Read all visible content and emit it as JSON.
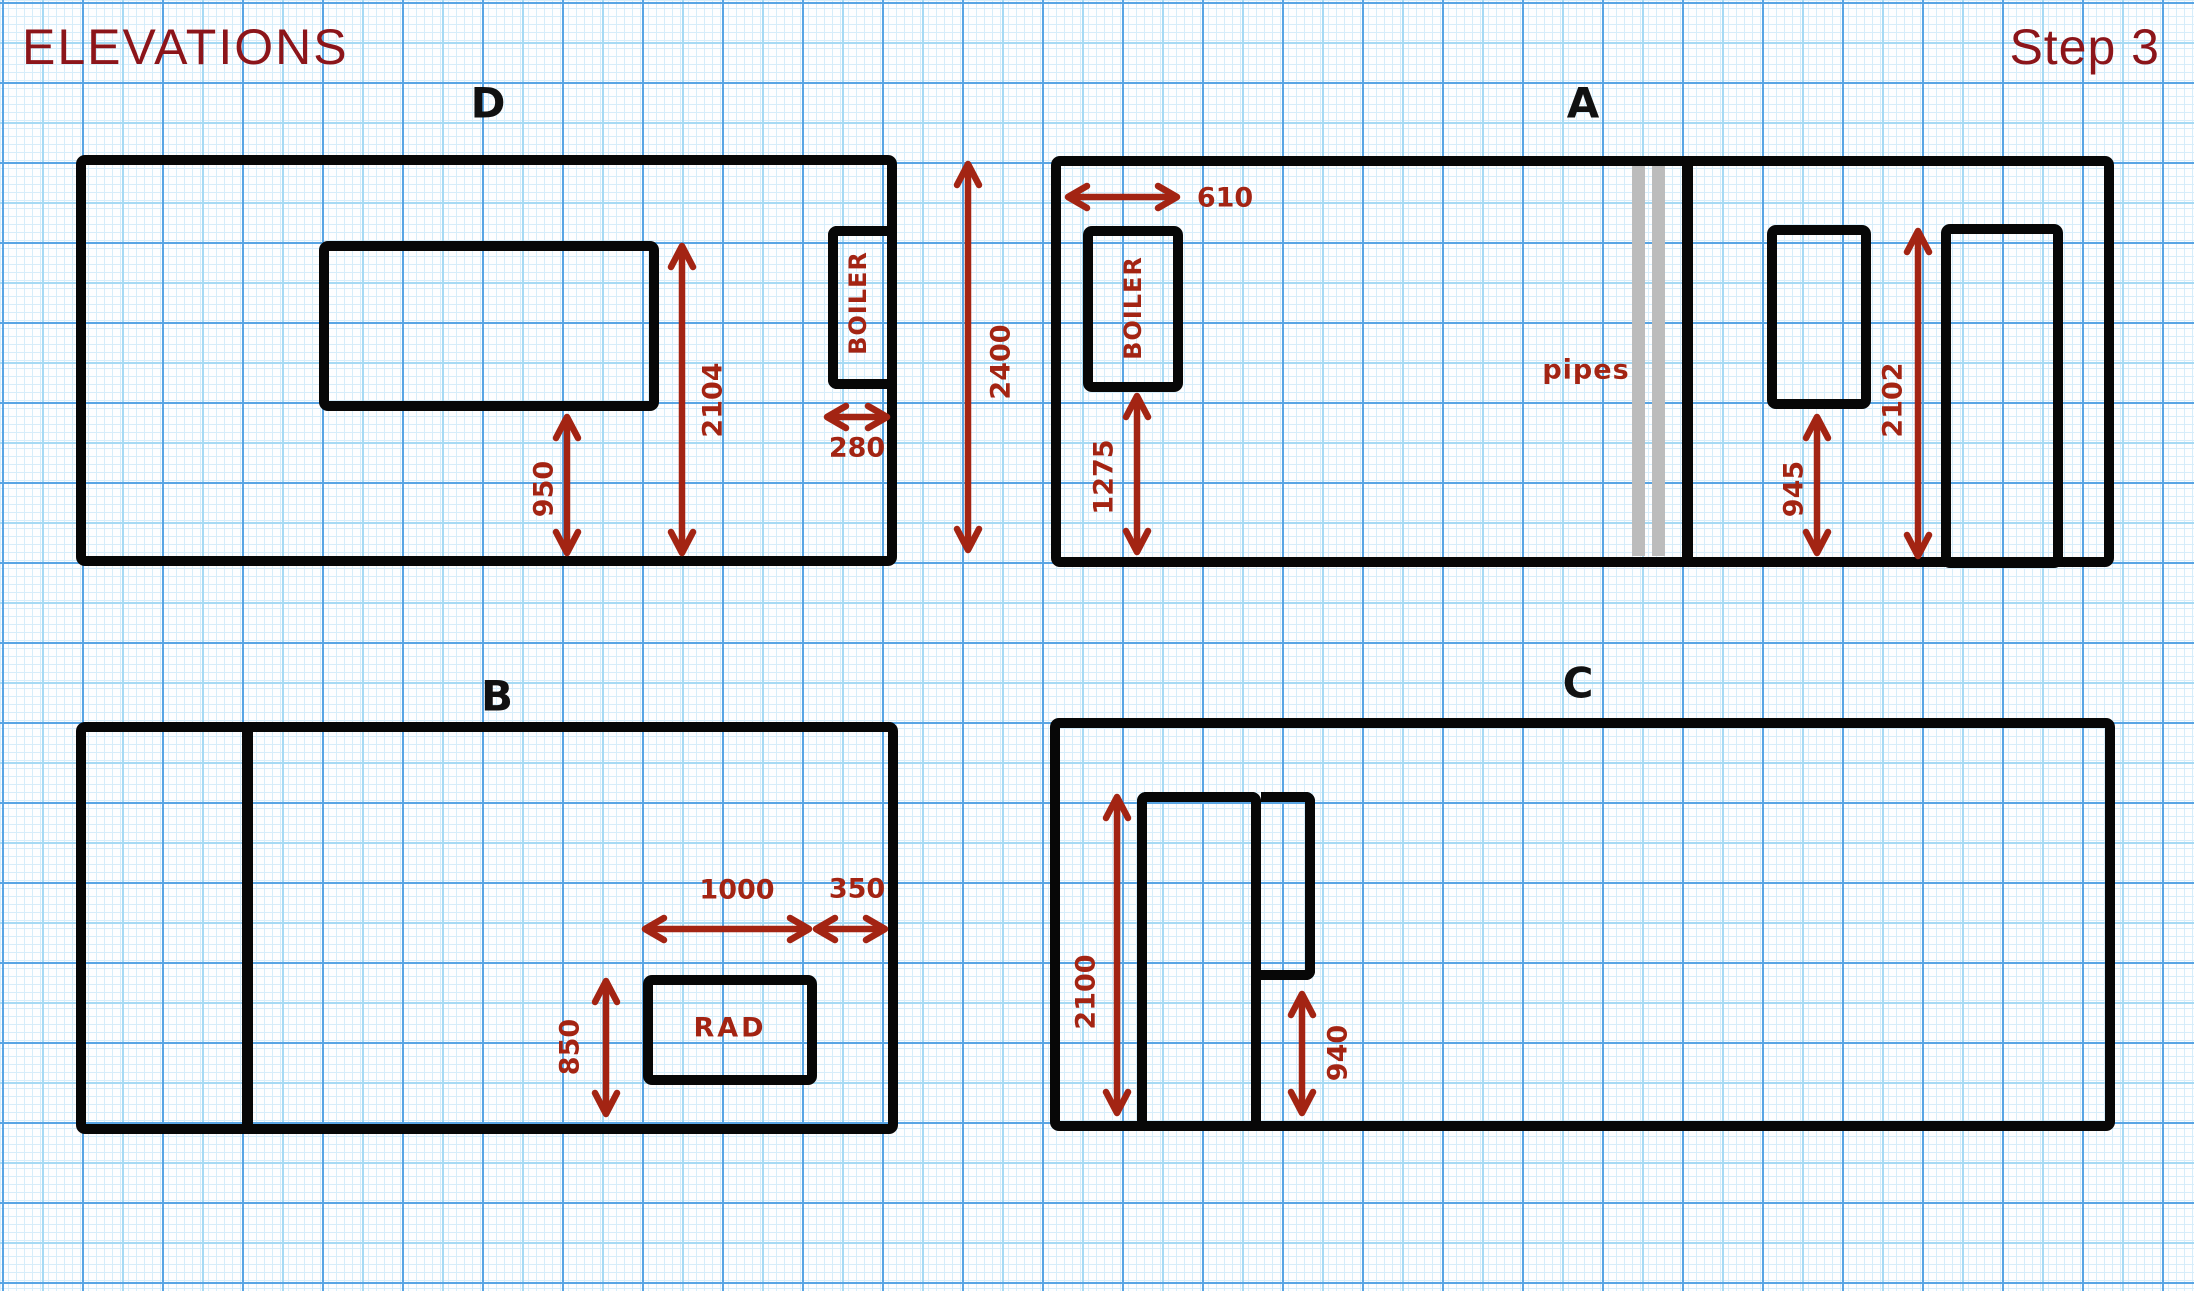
{
  "header": {
    "title": "ELEVATIONS",
    "step": "Step 3"
  },
  "colors": {
    "wall": "#070707",
    "dimension": "#a32413",
    "heading": "#8c151a",
    "pipe_gray": "#bcbcbc",
    "grid_major": "#58a5e4",
    "grid_medium": "#a6daf4",
    "grid_fine": "#d6edfa"
  },
  "d": {
    "label": "D",
    "boiler": "BOILER",
    "dim_window_top_height": "2104",
    "dim_window_sill": "950",
    "dim_boiler_width": "280"
  },
  "shared": {
    "dim_ceiling_height": "2400"
  },
  "a": {
    "label": "A",
    "boiler": "BOILER",
    "dim_boiler_width": "610",
    "dim_boiler_bottom": "1275",
    "pipes": "pipes",
    "dim_window_sill": "945",
    "dim_door_height": "2102"
  },
  "b": {
    "label": "B",
    "rad": "RAD",
    "dim_rad_height": "850",
    "dim_rad_width": "1000",
    "dim_rad_offset": "350"
  },
  "c": {
    "label": "C",
    "dim_door_height": "2100",
    "dim_panel_bottom": "940"
  }
}
